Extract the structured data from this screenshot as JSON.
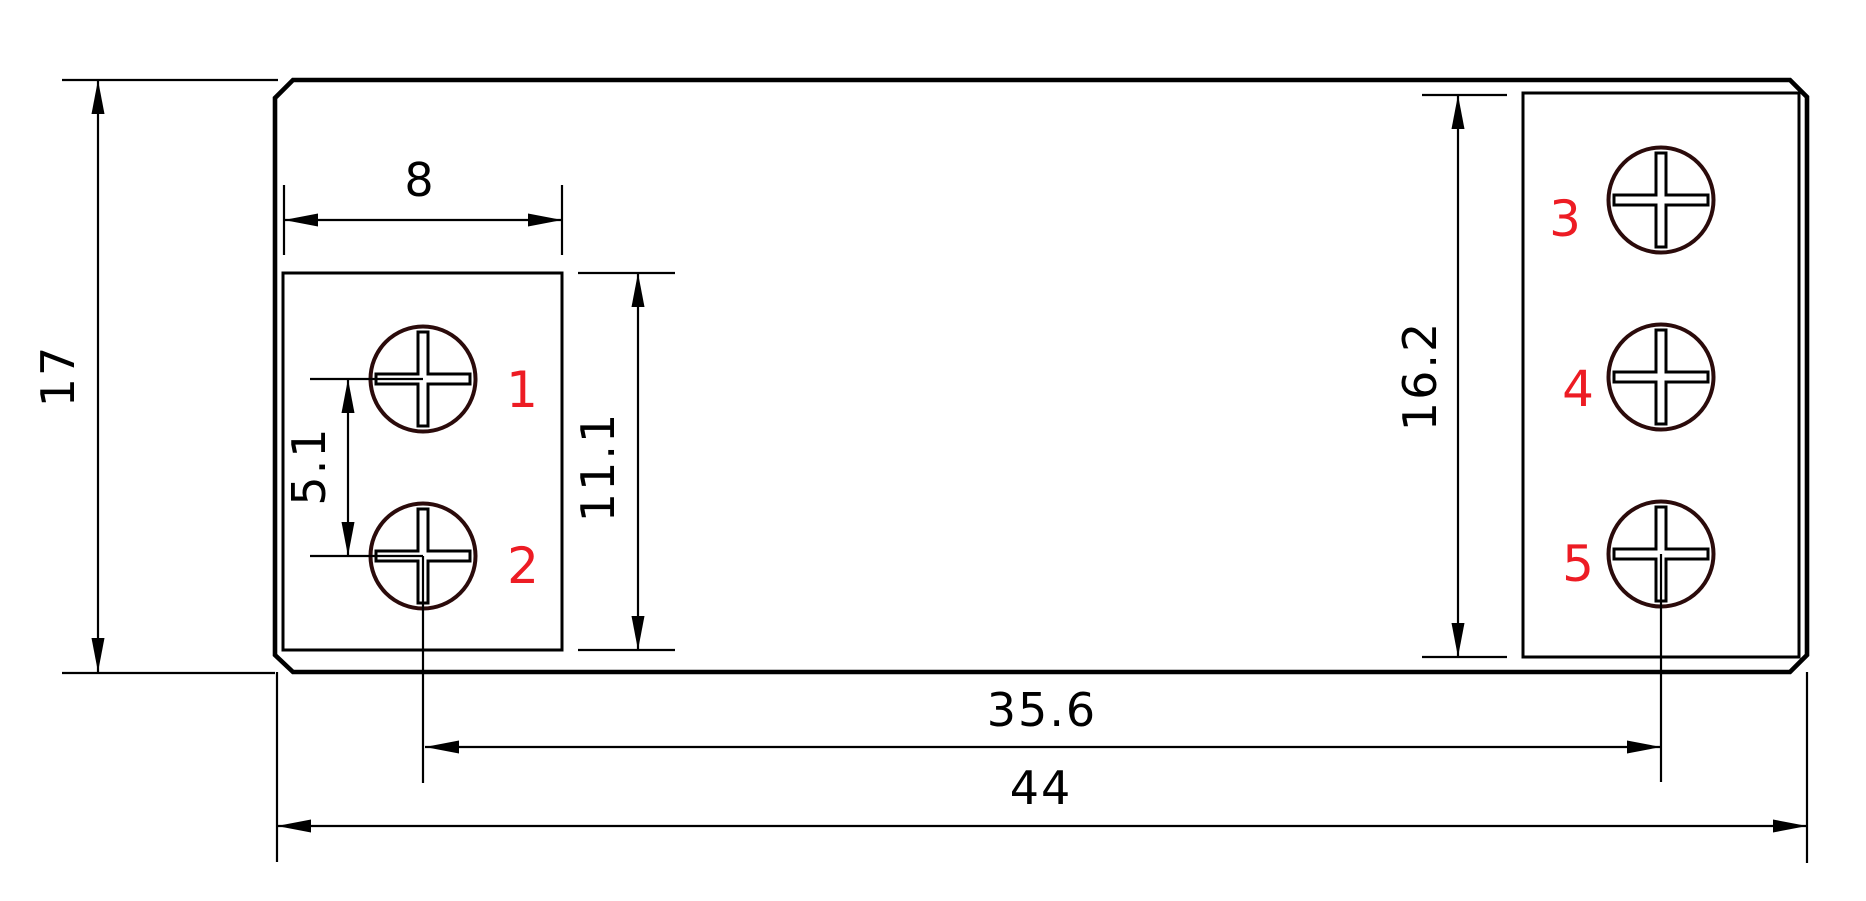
{
  "drawing": {
    "type": "technical-dimension-drawing",
    "dimensions": {
      "overall_height": "17",
      "overall_width": "44",
      "terminal_span": "35.6",
      "left_block_width": "8",
      "left_terminal_pitch": "5.1",
      "left_block_height": "11.1",
      "right_block_height": "16.2"
    },
    "terminals": [
      {
        "label": "1"
      },
      {
        "label": "2"
      },
      {
        "label": "3"
      },
      {
        "label": "4"
      },
      {
        "label": "5"
      }
    ],
    "colors": {
      "line": "#000000",
      "screw_outline": "#2b0b0b",
      "terminal_label_red": "#ed1c24",
      "background": "#ffffff"
    }
  }
}
